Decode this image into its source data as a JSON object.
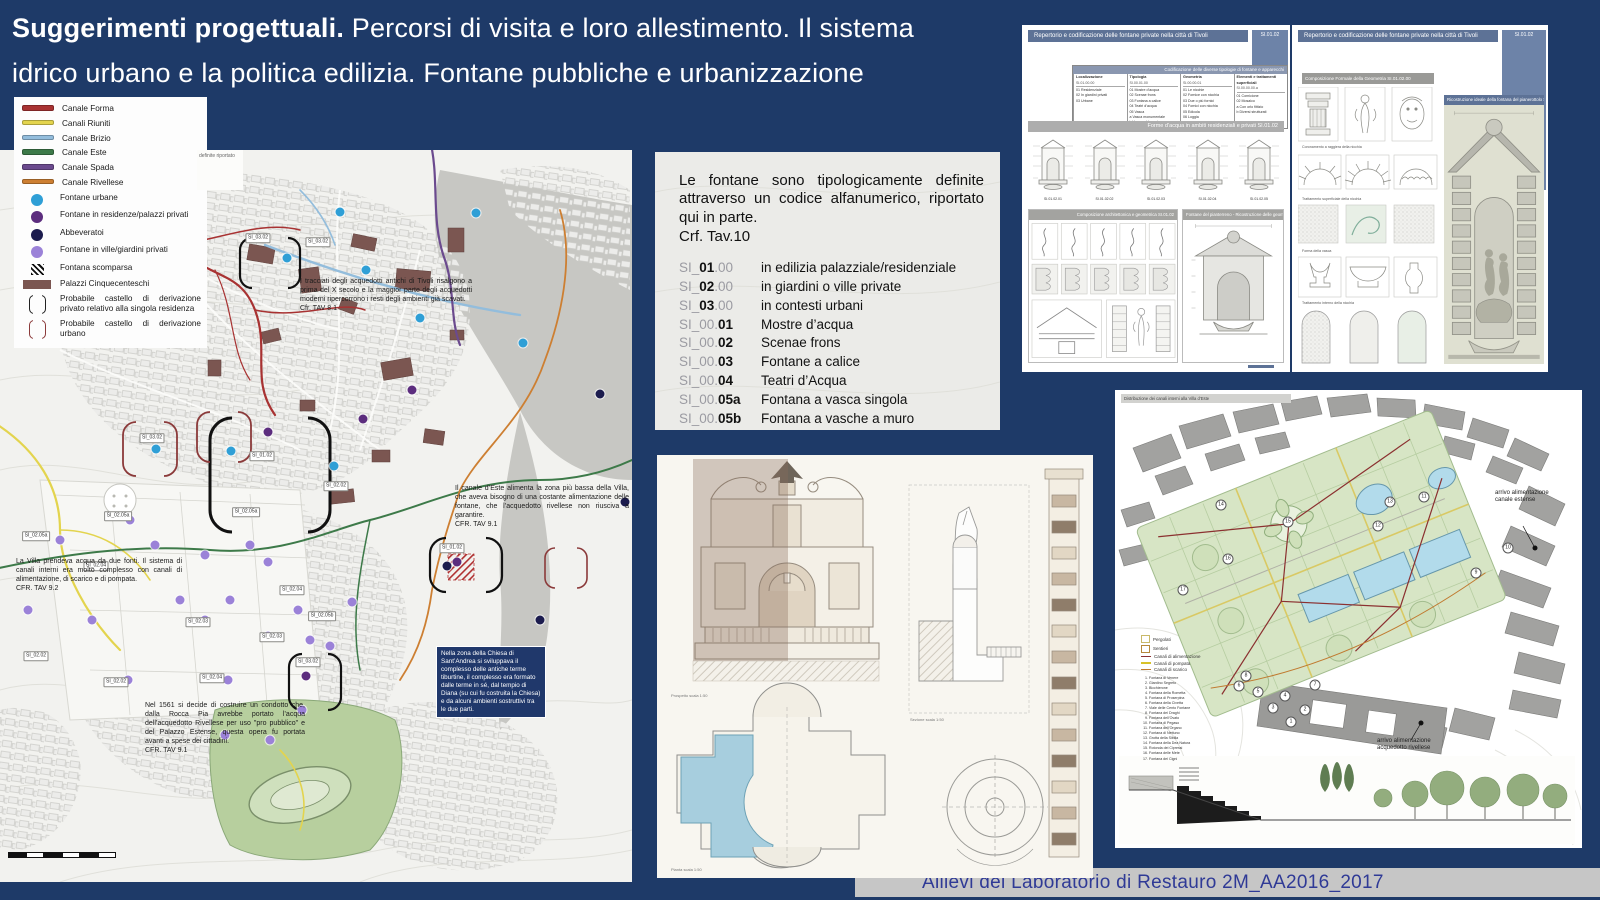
{
  "title": {
    "bold": "Suggerimenti progettuali.",
    "rest": " Percorsi di visita e loro allestimento. Il sistema",
    "line2": "idrico urbano e la politica edilizia. Fontane pubbliche e urbanizzazione"
  },
  "legend": {
    "items": [
      {
        "cls": "sw-line",
        "color": "#a83232",
        "label": "Canale Forma"
      },
      {
        "cls": "sw-line",
        "color": "#e3d44e",
        "label": "Canali Riuniti"
      },
      {
        "cls": "sw-line",
        "color": "#93bddc",
        "label": "Canale Brizio"
      },
      {
        "cls": "sw-line",
        "color": "#3d7a49",
        "label": "Canale Este"
      },
      {
        "cls": "sw-line",
        "color": "#6b4a8e",
        "label": "Canale Spada"
      },
      {
        "cls": "sw-line",
        "color": "#cd7f32",
        "label": "Canale Rivellese"
      },
      {
        "cls": "sw-dot",
        "color": "#2f9fd6",
        "label": "Fontane urbane"
      },
      {
        "cls": "sw-dot",
        "color": "#5c2d7e",
        "label": "Fontane in residenze/palazzi privati"
      },
      {
        "cls": "sw-dot",
        "color": "#1c1c4e",
        "label": "Abbeveratoi"
      },
      {
        "cls": "sw-dot",
        "color": "#9b82d8",
        "label": "Fontane in ville/giardini privati"
      },
      {
        "cls": "sw-hatch",
        "color": "#111111",
        "label": "Fontana scomparsa"
      },
      {
        "cls": "sw-rect",
        "color": "#7b5651",
        "label": "Palazzi Cinquecenteschi"
      },
      {
        "cls": "sw-bracket",
        "color": "#222222",
        "label": "Probabile castello di derivazione privato relativo alla singola residenza"
      },
      {
        "cls": "sw-bracket",
        "color": "#8b3a3a",
        "label": "Probabile castello di derivazione urbano"
      }
    ]
  },
  "codes": {
    "paragraph": "Le fontane sono tipologicamente definite attraverso un codice alfanumerico, riportato qui in parte.",
    "ref": "Crf. Tav.10",
    "rows": [
      {
        "prefix": "SI_",
        "bold": "01",
        "suffix": ".00",
        "desc": "in edilizia palazziale/residenziale"
      },
      {
        "prefix": "SI_",
        "bold": "02",
        "suffix": ".00",
        "desc": "in giardini o ville private"
      },
      {
        "prefix": "SI_",
        "bold": "03",
        "suffix": ".00",
        "desc": "in contesti urbani"
      },
      {
        "prefix": "SI_00.",
        "bold": "01",
        "suffix": "",
        "desc": "Mostre d’acqua"
      },
      {
        "prefix": "SI_00.",
        "bold": "02",
        "suffix": "",
        "desc": "Scenae frons"
      },
      {
        "prefix": "SI_00.",
        "bold": "03",
        "suffix": "",
        "desc": "Fontane a calice"
      },
      {
        "prefix": "SI_00.",
        "bold": "04",
        "suffix": "",
        "desc": "Teatri d’Acqua"
      },
      {
        "prefix": "SI_00.",
        "bold": "05a",
        "suffix": "",
        "desc": "Fontana a vasca singola"
      },
      {
        "prefix": "SI_00.",
        "bold": "05b",
        "suffix": "",
        "desc": "Fontana a vasche a muro"
      }
    ]
  },
  "map": {
    "fragment": "definite riportato",
    "notes": [
      {
        "x": 300,
        "y": 128,
        "w": 172,
        "cls": "light",
        "text": "I tracciati degli acquedotti antichi di Tivoli risalgono a prima del X secolo e la maggior parte degli acquedotti moderni ripercorrono i resti degli ambienti già scavati.",
        "ref": "Cfr. TAV 8.1"
      },
      {
        "x": 455,
        "y": 335,
        "w": 174,
        "cls": "light",
        "text": "Il canale d’Este alimenta la zona più bassa della Villa, che aveva bisogno di una costante alimentazione delle fontane, che l’acquedotto rivellese non riusciva a garantire.",
        "ref": "CFR. TAV 9.1"
      },
      {
        "x": 16,
        "y": 408,
        "w": 166,
        "cls": "light",
        "text": "La Villa prendeva acqua da due fonti. Il sistema di canali interni era molto complesso con canali di alimentazione, di scarico e di pompata.",
        "ref": "CFR. TAV 9.2"
      },
      {
        "x": 436,
        "y": 496,
        "w": 100,
        "cls": "dark",
        "text": "Nella zona della Chiesa di Sant’Andrea si sviluppava il complesso delle antiche terme tiburtine, il complesso era formato dalle terme in sé, dal tempio di Diana (su cui fu costruita la Chiesa) e da alcuni ambienti sostruttivi tra le due parti.",
        "ref": ""
      },
      {
        "x": 145,
        "y": 552,
        "w": 160,
        "cls": "light",
        "text": "Nel 1561 si decide di costruire un condotto che, dalla Rocca Pia avrebbe portato l’acqua dell’acquedotto Rivellese per uso \"pro pubblico\" e del Palazzo Estense, questa opera fu portata avanti a spese dei cittadini.",
        "ref": "CFR. TAV 9.1"
      }
    ],
    "dots": [
      {
        "x": 287,
        "y": 108,
        "color": "#2f9fd6"
      },
      {
        "x": 340,
        "y": 62,
        "color": "#2f9fd6"
      },
      {
        "x": 476,
        "y": 63,
        "color": "#2f9fd6"
      },
      {
        "x": 523,
        "y": 193,
        "color": "#2f9fd6"
      },
      {
        "x": 334,
        "y": 316,
        "color": "#2f9fd6"
      },
      {
        "x": 156,
        "y": 299,
        "color": "#2f9fd6"
      },
      {
        "x": 231,
        "y": 301,
        "color": "#2f9fd6"
      },
      {
        "x": 366,
        "y": 120,
        "color": "#2f9fd6"
      },
      {
        "x": 420,
        "y": 168,
        "color": "#2f9fd6"
      },
      {
        "x": 268,
        "y": 282,
        "color": "#5c2d7e"
      },
      {
        "x": 363,
        "y": 269,
        "color": "#5c2d7e"
      },
      {
        "x": 457,
        "y": 412,
        "color": "#5c2d7e"
      },
      {
        "x": 306,
        "y": 526,
        "color": "#5c2d7e"
      },
      {
        "x": 412,
        "y": 240,
        "color": "#5c2d7e"
      },
      {
        "x": 600,
        "y": 244,
        "color": "#1c1c4e"
      },
      {
        "x": 625,
        "y": 352,
        "color": "#1c1c4e"
      },
      {
        "x": 447,
        "y": 416,
        "color": "#1c1c4e"
      },
      {
        "x": 540,
        "y": 470,
        "color": "#1c1c4e"
      },
      {
        "x": 130,
        "y": 370,
        "color": "#9b82d8"
      },
      {
        "x": 155,
        "y": 395,
        "color": "#9b82d8"
      },
      {
        "x": 205,
        "y": 405,
        "color": "#9b82d8"
      },
      {
        "x": 250,
        "y": 395,
        "color": "#9b82d8"
      },
      {
        "x": 268,
        "y": 412,
        "color": "#9b82d8"
      },
      {
        "x": 298,
        "y": 460,
        "color": "#9b82d8"
      },
      {
        "x": 310,
        "y": 490,
        "color": "#9b82d8"
      },
      {
        "x": 268,
        "y": 486,
        "color": "#9b82d8"
      },
      {
        "x": 230,
        "y": 450,
        "color": "#9b82d8"
      },
      {
        "x": 180,
        "y": 450,
        "color": "#9b82d8"
      },
      {
        "x": 92,
        "y": 470,
        "color": "#9b82d8"
      },
      {
        "x": 60,
        "y": 390,
        "color": "#9b82d8"
      },
      {
        "x": 28,
        "y": 460,
        "color": "#9b82d8"
      },
      {
        "x": 128,
        "y": 530,
        "color": "#9b82d8"
      },
      {
        "x": 228,
        "y": 530,
        "color": "#9b82d8"
      },
      {
        "x": 330,
        "y": 496,
        "color": "#9b82d8"
      },
      {
        "x": 205,
        "y": 470,
        "color": "#9b82d8"
      },
      {
        "x": 302,
        "y": 560,
        "color": "#9b82d8"
      },
      {
        "x": 225,
        "y": 585,
        "color": "#9b82d8"
      },
      {
        "x": 270,
        "y": 590,
        "color": "#9b82d8"
      },
      {
        "x": 352,
        "y": 452,
        "color": "#9b82d8"
      }
    ],
    "chips": [
      {
        "x": 258,
        "y": 88,
        "label": "SI_03.02"
      },
      {
        "x": 318,
        "y": 92,
        "label": "SI_03.02"
      },
      {
        "x": 152,
        "y": 288,
        "label": "SI_03.02"
      },
      {
        "x": 262,
        "y": 306,
        "label": "SI_01.02"
      },
      {
        "x": 452,
        "y": 398,
        "label": "SI_01.02"
      },
      {
        "x": 336,
        "y": 336,
        "label": "SI_02.02"
      },
      {
        "x": 246,
        "y": 362,
        "label": "SI_02.05a"
      },
      {
        "x": 118,
        "y": 366,
        "label": "SI_02.05a"
      },
      {
        "x": 36,
        "y": 386,
        "label": "SI_02.05a"
      },
      {
        "x": 96,
        "y": 416,
        "label": "SI_02.04"
      },
      {
        "x": 292,
        "y": 440,
        "label": "SI_02.04"
      },
      {
        "x": 322,
        "y": 466,
        "label": "SI_02.05b"
      },
      {
        "x": 198,
        "y": 472,
        "label": "SI_02.03"
      },
      {
        "x": 272,
        "y": 487,
        "label": "SI_02.03"
      },
      {
        "x": 36,
        "y": 506,
        "label": "SI_02.02"
      },
      {
        "x": 116,
        "y": 532,
        "label": "SI_02.02"
      },
      {
        "x": 212,
        "y": 528,
        "label": "SI_02.04"
      },
      {
        "x": 308,
        "y": 512,
        "label": "SI_03.02"
      }
    ]
  },
  "panel_a": {
    "header": "Repertorio e codificazione delle fontane private nella città di Tivoli",
    "code": "SI.01.02",
    "table_title": "Codificazione delle diverse tipologie di fontane e apparecchi",
    "columns": [
      {
        "title": "Localizzazione",
        "code": "SI.01.00.00",
        "items": [
          "01  Residenziale",
          "02  In giardini privati",
          "03  Urbane"
        ]
      },
      {
        "title": "Tipologia",
        "code": "SI.00.01.00",
        "items": [
          "01  Mostre d’acqua",
          "02  Scenae frons",
          "03  Fontana a calice",
          "04  Teatri d’acqua",
          "05  Vasca",
          "a  Vasca monumentale",
          "b  Vasca addossata"
        ]
      },
      {
        "title": "Geometria",
        "code": "SI.00.00.01",
        "items": [
          "01  Le nicchie",
          "02  Fornice con nicchia",
          "03  Due o più fornici",
          "04  Fornici con nicchia",
          "05  Edicola",
          "06  Loggia"
        ]
      },
      {
        "title": "Elementi e trattamenti superficiali",
        "code": "SI.00.00.00.a",
        "items": [
          "01  Cornicione",
          "02  Mosaico",
          "a  Con orlo fittizio",
          "b  Diversi strutturati"
        ]
      }
    ],
    "band": "Forme d’acqua in ambiti residenziali e privati SI.01.02",
    "thumbs": [
      "SI.01.02.01",
      "SI.01.02.02",
      "SI.01.02.03",
      "SI.01.02.04",
      "SI.01.02.05"
    ],
    "sub_left": "Composizione architettonica e geometrica SI.01.02",
    "sub_right": "Fontane del pianterreno - Ricostruzione delle geometrie"
  },
  "panel_b": {
    "header": "Repertorio e codificazione delle fontane private nella città di Tivoli",
    "code": "SI.01.02",
    "subheader": "Composizione Formale della Geometria SI.01.02.00",
    "band": "Ricostruzione ideale della fontana del pianerottolo SI.01.02.05a",
    "cats": [
      "Coronamento a raggiera della nicchia",
      "Trattamento superficiale della nicchia",
      "Forma della vasca",
      "Trattamento interno della nicchia"
    ]
  },
  "drawings": {
    "captions": [
      "Prospetto scala 1:50",
      "Sezione scala 1:50",
      "Pianta scala 1:50"
    ]
  },
  "garden": {
    "header": "Distribuzione dei canali interni alla Villa d’Este",
    "note1": "arrivo alimentazione canale estense",
    "note2": "arrivo alimentazione acquedotto rivellese",
    "legend": [
      {
        "cls": "sw-gsq",
        "color": "#c9b96a",
        "label": "Pergolati"
      },
      {
        "cls": "sw-gsq",
        "color": "#b5883a",
        "label": "Sentieri"
      },
      {
        "cls": "sw-gline",
        "color": "#8b3030",
        "label": "Canali di alimentazione"
      },
      {
        "cls": "sw-gline",
        "color": "#d8c22a",
        "label": "Canali di pompata"
      },
      {
        "cls": "sw-gline",
        "color": "#c07a30",
        "label": "Canali di scarico"
      }
    ],
    "fountains": [
      "Fontana di Venere",
      "Giardino Segreto",
      "Bicchierone",
      "Fontana della Rometta",
      "Fontana di Proserpina",
      "Fontana della Civetta",
      "Viale delle Cento Fontane",
      "Fontana dei Draghi",
      "Fontana dell’Ovato",
      "Fontana di Pegaso",
      "Fontana dell’Organo",
      "Fontana di Nettuno",
      "Grotta della Sibilla",
      "Fontana della Dea Natura",
      "Rotonda dei Cipressi",
      "Fontana delle Mete",
      "Fontana dei Cigni"
    ],
    "numbers": [
      {
        "n": "1",
        "x": 176,
        "y": 332
      },
      {
        "n": "2",
        "x": 190,
        "y": 320
      },
      {
        "n": "3",
        "x": 158,
        "y": 318
      },
      {
        "n": "4",
        "x": 170,
        "y": 306
      },
      {
        "n": "5",
        "x": 143,
        "y": 302
      },
      {
        "n": "6",
        "x": 124,
        "y": 296
      },
      {
        "n": "7",
        "x": 200,
        "y": 295
      },
      {
        "n": "8",
        "x": 131,
        "y": 286
      },
      {
        "n": "9",
        "x": 361,
        "y": 183
      },
      {
        "n": "10",
        "x": 393,
        "y": 158
      },
      {
        "n": "11",
        "x": 309,
        "y": 107
      },
      {
        "n": "12",
        "x": 263,
        "y": 136
      },
      {
        "n": "13",
        "x": 275,
        "y": 112
      },
      {
        "n": "14",
        "x": 106,
        "y": 115
      },
      {
        "n": "15",
        "x": 173,
        "y": 132
      },
      {
        "n": "16",
        "x": 113,
        "y": 169
      },
      {
        "n": "17",
        "x": 68,
        "y": 200
      }
    ]
  },
  "credit": "Allievi del Laboratorio di Restauro 2M_AA2016_2017"
}
